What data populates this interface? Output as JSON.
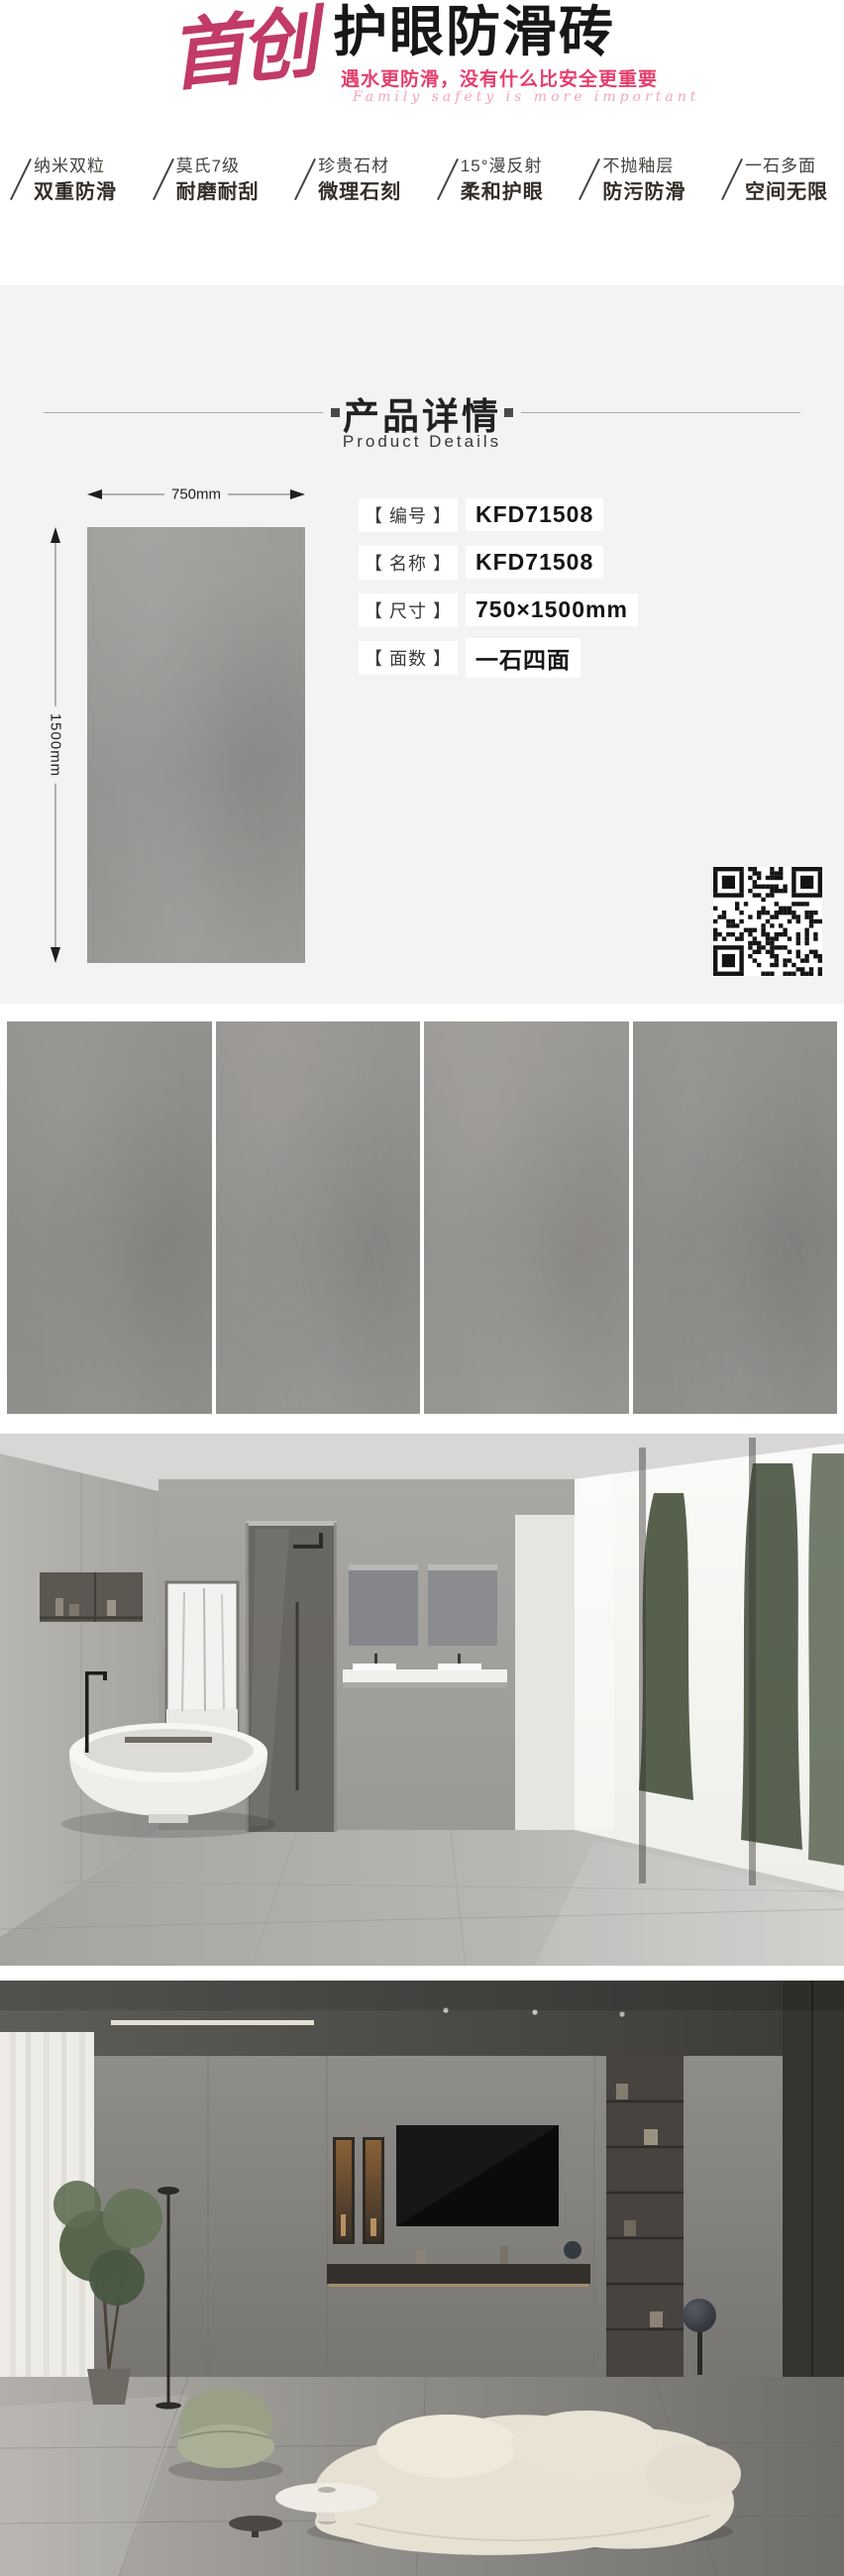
{
  "brand": {
    "logo": "首创",
    "title": "护眼防滑砖",
    "slogan_cn": "遇水更防滑，没有什么比安全更重要",
    "slogan_en": "Family safety is more important",
    "accent_color": "#e63e6c",
    "logo_color": "#c23a67"
  },
  "features": [
    {
      "line1": "纳米双粒",
      "line2": "双重防滑"
    },
    {
      "line1": "莫氏7级",
      "line2": "耐磨耐刮"
    },
    {
      "line1": "珍贵石材",
      "line2": "微理石刻"
    },
    {
      "line1": "15°漫反射",
      "line2": "柔和护眼"
    },
    {
      "line1": "不抛釉层",
      "line2": "防污防滑"
    },
    {
      "line1": "一石多面",
      "line2": "空间无限"
    }
  ],
  "details_section": {
    "title_cn": "产品详情",
    "title_en": "Product Details",
    "dimensions": {
      "width_label": "750mm",
      "height_label": "1500mm"
    },
    "specs": [
      {
        "label": "【 编号 】",
        "value": "KFD71508"
      },
      {
        "label": "【 名称 】",
        "value": "KFD71508"
      },
      {
        "label": "【 尺寸 】",
        "value": "750×1500mm"
      },
      {
        "label": "【 面数 】",
        "value": "一石四面"
      }
    ]
  },
  "gallery": {
    "tile_faces_count": 4,
    "scenes": [
      "bathroom-scene",
      "living-room-scene"
    ]
  },
  "colors": {
    "section_bg": "#f3f3f3",
    "tile_gray": "#908e8b",
    "text_dark": "#191715"
  }
}
